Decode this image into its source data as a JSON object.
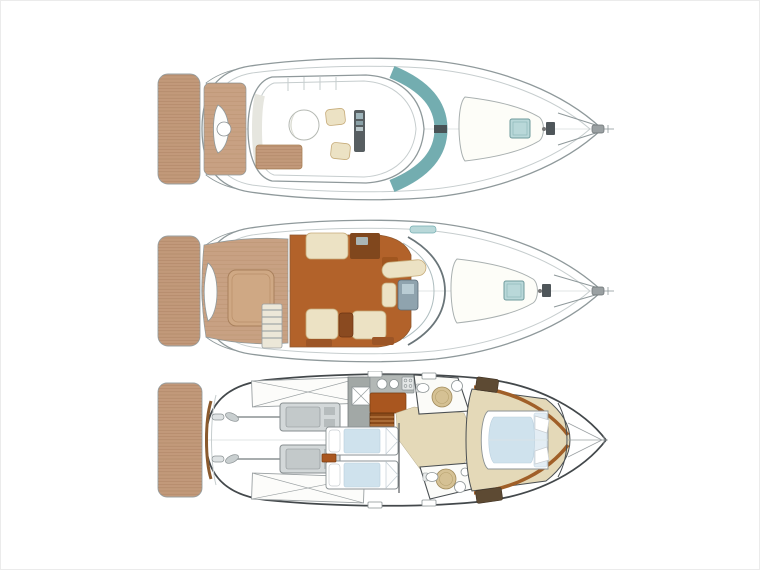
{
  "canvas": {
    "width": 760,
    "height": 570,
    "background": "#ffffff",
    "frame_color": "#ebebeb"
  },
  "diagram": {
    "type": "boat-deck-plans",
    "orientation": "bow-right",
    "decks": [
      {
        "id": "flybridge-deck",
        "features": [
          "swim-platform",
          "radar-arch-arms",
          "aft-cockpit",
          "cockpit-bench",
          "cockpit-table",
          "flybridge-platform",
          "l-shaped-seating",
          "sunpad",
          "round-table",
          "companion-seats",
          "helm-console",
          "wraparound-windshield",
          "foredeck-sunpad",
          "deck-hatch",
          "anchor-windlass",
          "bow-pulpit",
          "anchor"
        ]
      },
      {
        "id": "main-deck",
        "features": [
          "swim-platform",
          "radar-arch-arms",
          "aft-cockpit",
          "transom-bench",
          "engine-hatch",
          "flybridge-ladder",
          "salon-floor",
          "aft-settee",
          "sideboard",
          "dinette-bench",
          "facing-sofas",
          "salon-table",
          "helm-seat",
          "helm-console",
          "windshield",
          "roof-vent",
          "foredeck-sunpad",
          "deck-hatch",
          "anchor-windlass",
          "bow-pulpit",
          "anchor"
        ]
      },
      {
        "id": "lower-deck",
        "features": [
          "swim-platform",
          "transom-trim",
          "engine-room",
          "fuel-tank-aft",
          "fuel-tank-fwd",
          "port-engine",
          "starboard-engine",
          "prop-shafts",
          "propellers",
          "rudders",
          "galley-wall",
          "fridge",
          "galley-sinks",
          "stove",
          "galley-counter",
          "staircase",
          "corridor",
          "aft-head",
          "shower-aft",
          "toilet-aft",
          "sink-aft",
          "guest-cabin",
          "twin-bed-port",
          "twin-bed-starboard",
          "nightstand",
          "fwd-head",
          "shower-fwd",
          "toilet-fwd",
          "sink-fwd",
          "owner-cabin",
          "island-bed",
          "wardrobes",
          "caprail-trim",
          "collision-bulkhead",
          "anchor-locker",
          "hull-portlights"
        ]
      }
    ],
    "colors": {
      "bg": "#ffffff",
      "frame": "#ebebeb",
      "teak": "#c2997a",
      "teak_seam": "#9e7653",
      "cockpit_teak": "#c8a183",
      "salon_floor": "#b2622a",
      "wood_dark": "#80471d",
      "cream": "#ece2c4",
      "cream_edge": "#c6ab79",
      "teal": "#73adb0",
      "teal_light": "#b9d8d9",
      "hull_line": "#8f999b",
      "inner_line": "#c6cdce",
      "lower_line": "#43484b",
      "beige_floor": "#e4d9b8",
      "counter_gray": "#a2a8a6",
      "bed_blue": "#cfe2ed"
    }
  }
}
